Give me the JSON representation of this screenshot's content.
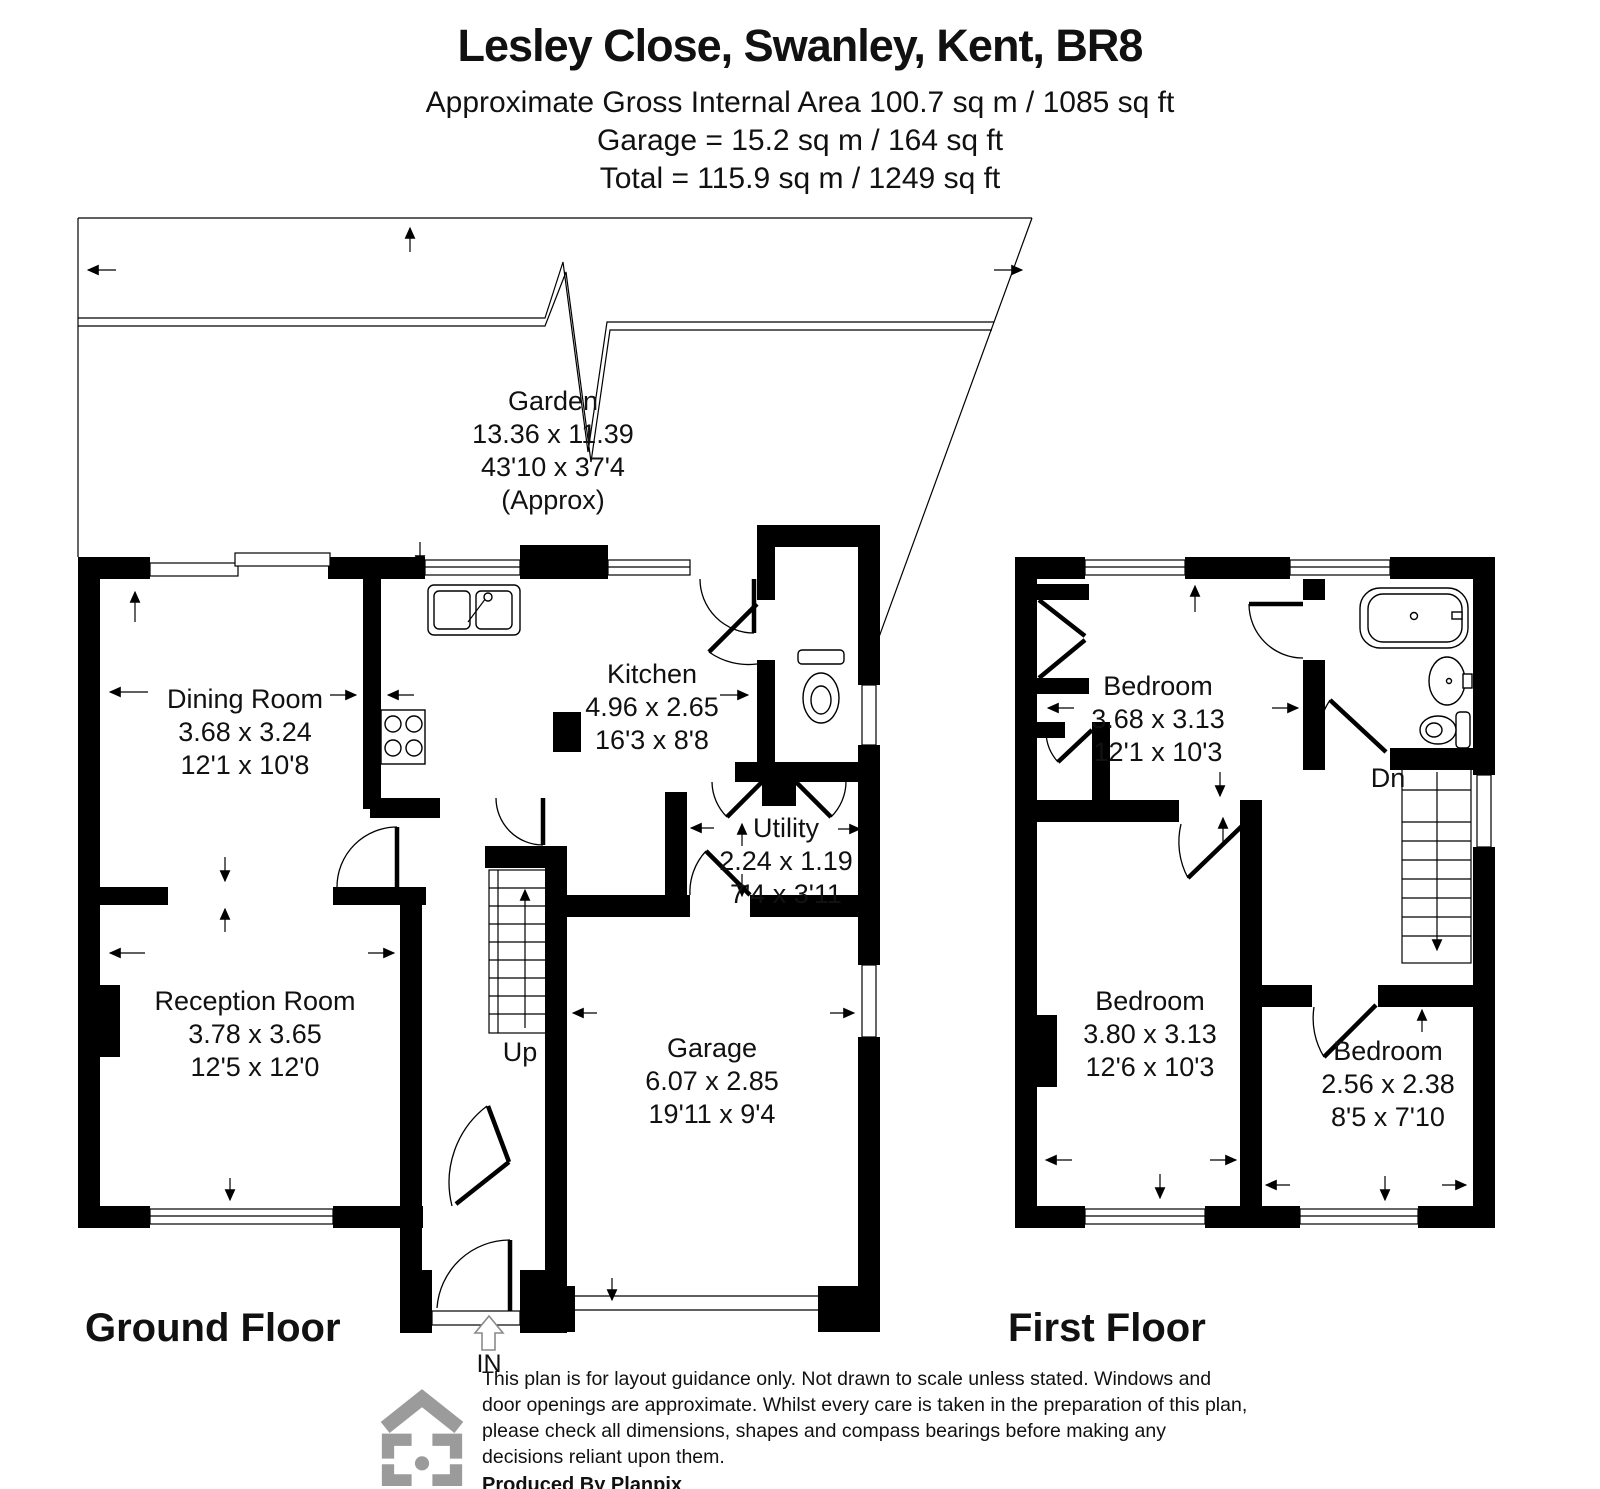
{
  "header": {
    "title": "Lesley Close, Swanley, Kent, BR8",
    "area_line": "Approximate Gross Internal Area  100.7 sq m / 1085 sq ft",
    "garage_line": "Garage = 15.2 sq m / 164 sq ft",
    "total_line": "Total = 115.9 sq m / 1249 sq ft"
  },
  "garden": {
    "name": "Garden",
    "metric": "13.36 x 11.39",
    "imperial": "43'10 x 37'4",
    "note": "(Approx)"
  },
  "ground_floor": {
    "label": "Ground Floor",
    "entrance_label": "IN",
    "stairs_label": "Up",
    "rooms": [
      {
        "name": "Dining Room",
        "metric": "3.68 x 3.24",
        "imperial": "12'1 x 10'8"
      },
      {
        "name": "Kitchen",
        "metric": "4.96 x 2.65",
        "imperial": "16'3 x 8'8"
      },
      {
        "name": "Utility",
        "metric": "2.24 x 1.19",
        "imperial": "7'4 x 3'11"
      },
      {
        "name": "Reception Room",
        "metric": "3.78 x 3.65",
        "imperial": "12'5 x 12'0"
      },
      {
        "name": "Garage",
        "metric": "6.07 x 2.85",
        "imperial": "19'11 x 9'4"
      }
    ]
  },
  "first_floor": {
    "label": "First Floor",
    "stairs_label": "Dn",
    "rooms": [
      {
        "name": "Bedroom",
        "metric": "3.68 x 3.13",
        "imperial": "12'1 x 10'3"
      },
      {
        "name": "Bedroom",
        "metric": "3.80 x 3.13",
        "imperial": "12'6 x 10'3"
      },
      {
        "name": "Bedroom",
        "metric": "2.56 x 2.38",
        "imperial": "8'5 x 7'10"
      }
    ]
  },
  "footer": {
    "disclaimer": "This plan is for layout guidance only. Not drawn to scale unless stated. Windows and door openings are approximate. Whilst every care is taken in the preparation of this plan, please check all dimensions, shapes and compass bearings before making any decisions reliant upon them.",
    "credit": "Produced By Planpix"
  },
  "colors": {
    "wall": "#000000",
    "logo_gray": "#9b9b9b"
  }
}
